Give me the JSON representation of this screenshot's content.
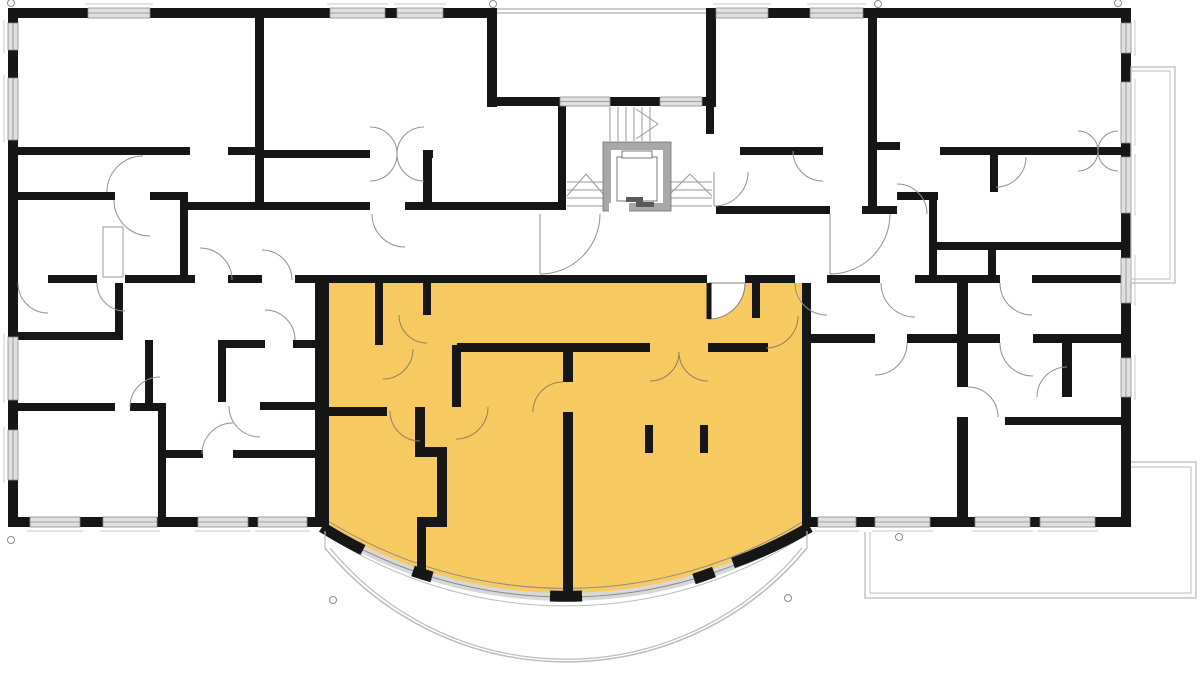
{
  "meta": {
    "width": 1200,
    "height": 691,
    "background": "#ffffff",
    "kind": "architectural-floor-plan"
  },
  "colors": {
    "wall": "#161616",
    "window_fill": "#e0e0e0",
    "window_frame": "#8a8a8a",
    "door_arc": "#909090",
    "door_arc_unit": "#8f8061",
    "highlight_unit": "#f6ca60",
    "balcony_line": "#bcbcbc",
    "elevator_wall": "#a8a8a8",
    "stair_line": "#9a9a9a",
    "sill_line": "#c8c8c8"
  },
  "plan": {
    "apartment_path": "M 329 283 L 806 283 L 810 527 A 460 460 0 0 1 322 527 Z",
    "walls": [
      [
        8,
        8,
        489,
        10
      ],
      [
        706,
        8,
        425,
        10
      ],
      [
        8,
        8,
        10,
        519
      ],
      [
        1121,
        8,
        10,
        519
      ],
      [
        8,
        517,
        307,
        10
      ],
      [
        810,
        517,
        321,
        10
      ],
      [
        487,
        8,
        10,
        99
      ],
      [
        706,
        8,
        10,
        99
      ],
      [
        487,
        97,
        73,
        9
      ],
      [
        610,
        97,
        50,
        9
      ],
      [
        702,
        97,
        14,
        9
      ],
      [
        558,
        97,
        8,
        113
      ],
      [
        706,
        97,
        8,
        37
      ],
      [
        255,
        8,
        9,
        202
      ],
      [
        8,
        147,
        182,
        8
      ],
      [
        228,
        147,
        36,
        8
      ],
      [
        264,
        150,
        106,
        8
      ],
      [
        423,
        150,
        10,
        8
      ],
      [
        423,
        158,
        9,
        44
      ],
      [
        18,
        192,
        97,
        8
      ],
      [
        150,
        192,
        38,
        8
      ],
      [
        180,
        196,
        8,
        87
      ],
      [
        188,
        202,
        182,
        8
      ],
      [
        405,
        202,
        153,
        8
      ],
      [
        8,
        275,
        10,
        8
      ],
      [
        48,
        275,
        49,
        8
      ],
      [
        125,
        275,
        70,
        8
      ],
      [
        228,
        275,
        34,
        8
      ],
      [
        295,
        275,
        412,
        8
      ],
      [
        745,
        275,
        50,
        8
      ],
      [
        827,
        275,
        53,
        8
      ],
      [
        915,
        275,
        85,
        8
      ],
      [
        1032,
        275,
        89,
        8
      ],
      [
        115,
        283,
        8,
        57
      ],
      [
        8,
        332,
        107,
        8
      ],
      [
        145,
        340,
        8,
        63
      ],
      [
        18,
        403,
        97,
        8
      ],
      [
        130,
        403,
        36,
        8
      ],
      [
        158,
        411,
        8,
        111
      ],
      [
        166,
        450,
        37,
        8
      ],
      [
        233,
        450,
        89,
        8
      ],
      [
        218,
        340,
        47,
        8
      ],
      [
        293,
        340,
        29,
        8
      ],
      [
        218,
        340,
        8,
        62
      ],
      [
        260,
        402,
        62,
        8
      ],
      [
        315,
        283,
        14,
        244
      ],
      [
        802,
        283,
        9,
        244
      ],
      [
        375,
        283,
        8,
        62
      ],
      [
        423,
        283,
        8,
        32
      ],
      [
        457,
        343,
        193,
        9
      ],
      [
        708,
        343,
        60,
        9
      ],
      [
        752,
        283,
        8,
        35
      ],
      [
        452,
        345,
        9,
        62
      ],
      [
        329,
        407,
        58,
        9
      ],
      [
        415,
        407,
        10,
        41
      ],
      [
        415,
        447,
        32,
        10
      ],
      [
        437,
        447,
        10,
        70
      ],
      [
        417,
        517,
        30,
        10
      ],
      [
        417,
        527,
        9,
        50
      ],
      [
        563,
        352,
        10,
        30
      ],
      [
        563,
        412,
        10,
        181
      ],
      [
        645,
        425,
        8,
        28
      ],
      [
        700,
        425,
        8,
        28
      ],
      [
        868,
        18,
        9,
        196
      ],
      [
        740,
        147,
        83,
        8
      ],
      [
        877,
        142,
        23,
        8
      ],
      [
        940,
        147,
        181,
        8
      ],
      [
        897,
        192,
        41,
        8
      ],
      [
        929,
        192,
        8,
        91
      ],
      [
        990,
        155,
        8,
        37
      ],
      [
        716,
        206,
        114,
        8
      ],
      [
        862,
        206,
        35,
        8
      ],
      [
        937,
        242,
        184,
        8
      ],
      [
        988,
        250,
        8,
        25
      ],
      [
        802,
        334,
        73,
        9
      ],
      [
        907,
        334,
        93,
        9
      ],
      [
        1033,
        334,
        88,
        9
      ],
      [
        957,
        283,
        11,
        104
      ],
      [
        957,
        417,
        11,
        105
      ],
      [
        1062,
        343,
        10,
        54
      ],
      [
        1005,
        417,
        116,
        8
      ]
    ],
    "windows": [
      [
        88,
        8,
        62,
        10,
        "t"
      ],
      [
        330,
        8,
        55,
        10,
        "t"
      ],
      [
        397,
        8,
        46,
        10,
        "t"
      ],
      [
        716,
        8,
        52,
        10,
        "t"
      ],
      [
        810,
        8,
        53,
        10,
        "t"
      ],
      [
        30,
        517,
        50,
        10,
        "b"
      ],
      [
        103,
        517,
        54,
        10,
        "b"
      ],
      [
        198,
        517,
        50,
        10,
        "b"
      ],
      [
        258,
        517,
        49,
        10,
        "b"
      ],
      [
        818,
        517,
        38,
        10,
        "b"
      ],
      [
        875,
        517,
        55,
        10,
        "b"
      ],
      [
        975,
        517,
        55,
        10,
        "b"
      ],
      [
        1040,
        517,
        55,
        10,
        "b"
      ],
      [
        8,
        23,
        10,
        27,
        "l"
      ],
      [
        8,
        78,
        10,
        62,
        "l"
      ],
      [
        8,
        337,
        10,
        63,
        "l"
      ],
      [
        8,
        430,
        10,
        50,
        "l"
      ],
      [
        1121,
        23,
        10,
        30,
        "r"
      ],
      [
        1121,
        82,
        10,
        61,
        "r"
      ],
      [
        1121,
        157,
        10,
        56,
        "r"
      ],
      [
        1121,
        258,
        10,
        45,
        "r"
      ],
      [
        1121,
        358,
        10,
        39,
        "r"
      ],
      [
        560,
        97,
        50,
        9,
        "n"
      ],
      [
        660,
        97,
        42,
        9,
        "n"
      ]
    ],
    "doors": [
      [
        150,
        200,
        36,
        90,
        180,
        "g",
        0
      ],
      [
        143,
        192,
        36,
        270,
        180,
        "g",
        0
      ],
      [
        48,
        283,
        30,
        90,
        180,
        "g",
        0
      ],
      [
        125,
        283,
        28,
        90,
        180,
        "g",
        0
      ],
      [
        200,
        280,
        32,
        270,
        0,
        "g",
        0
      ],
      [
        262,
        280,
        30,
        270,
        0,
        "g",
        0
      ],
      [
        265,
        340,
        30,
        270,
        0,
        "g",
        0
      ],
      [
        260,
        406,
        31,
        90,
        180,
        "g",
        0
      ],
      [
        233,
        454,
        31,
        270,
        180,
        "g",
        0
      ],
      [
        160,
        407,
        30,
        180,
        270,
        "g",
        0
      ],
      [
        405,
        214,
        33,
        90,
        180,
        "g",
        0
      ],
      [
        540,
        214,
        60,
        90,
        0,
        "g",
        1
      ],
      [
        714,
        172,
        34,
        90,
        0,
        "g",
        1
      ],
      [
        830,
        214,
        60,
        90,
        0,
        "g",
        1
      ],
      [
        897,
        214,
        30,
        270,
        0,
        "g",
        0
      ],
      [
        823,
        151,
        30,
        90,
        180,
        "g",
        0
      ],
      [
        996,
        157,
        30,
        90,
        0,
        "g",
        0
      ],
      [
        827,
        283,
        32,
        90,
        180,
        "g",
        0
      ],
      [
        915,
        283,
        34,
        90,
        180,
        "g",
        0
      ],
      [
        1032,
        283,
        32,
        90,
        180,
        "g",
        0
      ],
      [
        875,
        343,
        32,
        90,
        0,
        "g",
        0
      ],
      [
        1033,
        343,
        33,
        90,
        180,
        "g",
        0
      ],
      [
        1067,
        397,
        30,
        180,
        270,
        "g",
        0
      ],
      [
        968,
        417,
        30,
        0,
        270,
        "g",
        0
      ],
      [
        1078,
        151,
        20,
        270,
        0,
        "g",
        0
      ],
      [
        1078,
        151,
        20,
        90,
        0,
        "g",
        0
      ],
      [
        1118,
        151,
        20,
        270,
        180,
        "g",
        0
      ],
      [
        1118,
        151,
        20,
        90,
        180,
        "g",
        0
      ],
      [
        370,
        154,
        27,
        270,
        0,
        "g",
        0
      ],
      [
        370,
        154,
        27,
        90,
        0,
        "g",
        0
      ],
      [
        424,
        154,
        27,
        270,
        180,
        "g",
        0
      ],
      [
        424,
        154,
        27,
        90,
        180,
        "g",
        0
      ],
      [
        383,
        349,
        30,
        90,
        0,
        "y",
        0
      ],
      [
        427,
        315,
        28,
        90,
        180,
        "y",
        0
      ],
      [
        650,
        352,
        29,
        90,
        0,
        "y",
        0
      ],
      [
        708,
        352,
        29,
        90,
        180,
        "y",
        0
      ],
      [
        766,
        316,
        32,
        90,
        0,
        "y",
        0
      ],
      [
        456,
        407,
        32,
        90,
        0,
        "y",
        0
      ],
      [
        563,
        412,
        30,
        270,
        180,
        "y",
        0
      ],
      [
        420,
        411,
        30,
        90,
        180,
        "y",
        0
      ]
    ],
    "entrance_sector": [
      709,
      283,
      36,
      90,
      0
    ],
    "arcsegs": [
      [
        322,
        527,
        810,
        527,
        460,
        0,
        "#d8d8d8",
        8
      ],
      [
        322,
        527,
        810,
        527,
        460,
        0,
        "#8a8a8a",
        1
      ],
      [
        328,
        521,
        804,
        521,
        454,
        0,
        "#8a8a8a",
        1
      ],
      [
        328,
        536,
        804,
        536,
        440,
        0,
        "#bcbcbc",
        1
      ],
      [
        325,
        548,
        807,
        548,
        312,
        0,
        "#bcbcbc",
        1.5
      ],
      [
        330,
        548,
        802,
        548,
        306,
        0,
        "#bcbcbc",
        1.2
      ],
      [
        322,
        527,
        363,
        550,
        460,
        0,
        "#161616",
        11
      ],
      [
        413,
        571,
        432,
        577,
        460,
        0,
        "#161616",
        11
      ],
      [
        550,
        596,
        582,
        596,
        460,
        0,
        "#161616",
        11
      ],
      [
        694,
        579,
        714,
        572,
        460,
        0,
        "#161616",
        11
      ],
      [
        733,
        563,
        810,
        527,
        460,
        0,
        "#161616",
        11
      ]
    ],
    "stair_lines": [
      [
        610,
        107,
        610,
        141
      ],
      [
        618,
        107,
        618,
        141
      ],
      [
        626,
        107,
        626,
        141
      ],
      [
        634,
        107,
        634,
        141
      ],
      [
        642,
        107,
        642,
        141
      ],
      [
        650,
        107,
        650,
        141
      ],
      [
        658,
        124,
        636,
        109
      ],
      [
        658,
        124,
        636,
        139
      ],
      [
        567,
        182,
        605,
        182
      ],
      [
        567,
        190,
        605,
        190
      ],
      [
        567,
        198,
        605,
        198
      ],
      [
        567,
        206,
        605,
        206
      ],
      [
        567,
        196,
        586,
        174
      ],
      [
        586,
        174,
        605,
        196
      ],
      [
        668,
        182,
        712,
        182
      ],
      [
        668,
        190,
        712,
        190
      ],
      [
        668,
        198,
        712,
        198
      ],
      [
        668,
        206,
        712,
        206
      ],
      [
        668,
        196,
        690,
        174
      ],
      [
        690,
        174,
        712,
        196
      ]
    ],
    "misc_lines": [
      [
        497,
        9,
        706,
        9,
        "#9a9a9a",
        1
      ],
      [
        497,
        13,
        706,
        13,
        "#9a9a9a",
        1
      ],
      [
        325,
        531,
        325,
        548,
        "#bcbcbc",
        1.2
      ],
      [
        807,
        531,
        807,
        548,
        "#bcbcbc",
        1.2
      ],
      [
        709,
        283,
        709,
        319,
        "#161616",
        5
      ]
    ],
    "polylines": [
      {
        "pts": [
          [
            865,
            532
          ],
          [
            865,
            598
          ],
          [
            1196,
            598
          ],
          [
            1196,
            462
          ],
          [
            1131,
            462
          ]
        ],
        "color": "#bcbcbc",
        "w": 1.3
      },
      {
        "pts": [
          [
            870,
            532
          ],
          [
            870,
            593
          ],
          [
            1191,
            593
          ],
          [
            1191,
            467
          ],
          [
            1131,
            467
          ]
        ],
        "color": "#bcbcbc",
        "w": 1
      }
    ],
    "rects": [
      [
        603,
        142,
        68,
        69,
        "#a8a8a8",
        "#707070",
        0.8
      ],
      [
        611,
        150,
        52,
        53,
        "#ffffff",
        "none",
        0
      ],
      [
        609,
        203,
        20,
        9,
        "#ffffff",
        "none",
        0
      ],
      [
        617,
        157,
        40,
        44,
        "#ffffff",
        "#7a7a7a",
        1
      ],
      [
        622,
        151,
        30,
        7,
        "#ffffff",
        "#7a7a7a",
        1
      ],
      [
        626,
        197,
        17,
        5,
        "#5a5a5a",
        "none",
        0
      ],
      [
        636,
        202,
        18,
        5,
        "#5a5a5a",
        "none",
        0
      ],
      [
        103,
        227,
        20,
        50,
        "#ffffff",
        "#9a9a9a",
        1
      ],
      [
        1131,
        67,
        44,
        216,
        "none",
        "#bcbcbc",
        1.3
      ],
      [
        1131,
        71,
        39,
        208,
        "none",
        "#bcbcbc",
        1
      ]
    ],
    "survey_circles": [
      [
        11,
        3
      ],
      [
        493,
        4
      ],
      [
        878,
        4
      ],
      [
        1118,
        3
      ],
      [
        11,
        540
      ],
      [
        899,
        537
      ],
      [
        333,
        600
      ],
      [
        788,
        598
      ]
    ]
  }
}
